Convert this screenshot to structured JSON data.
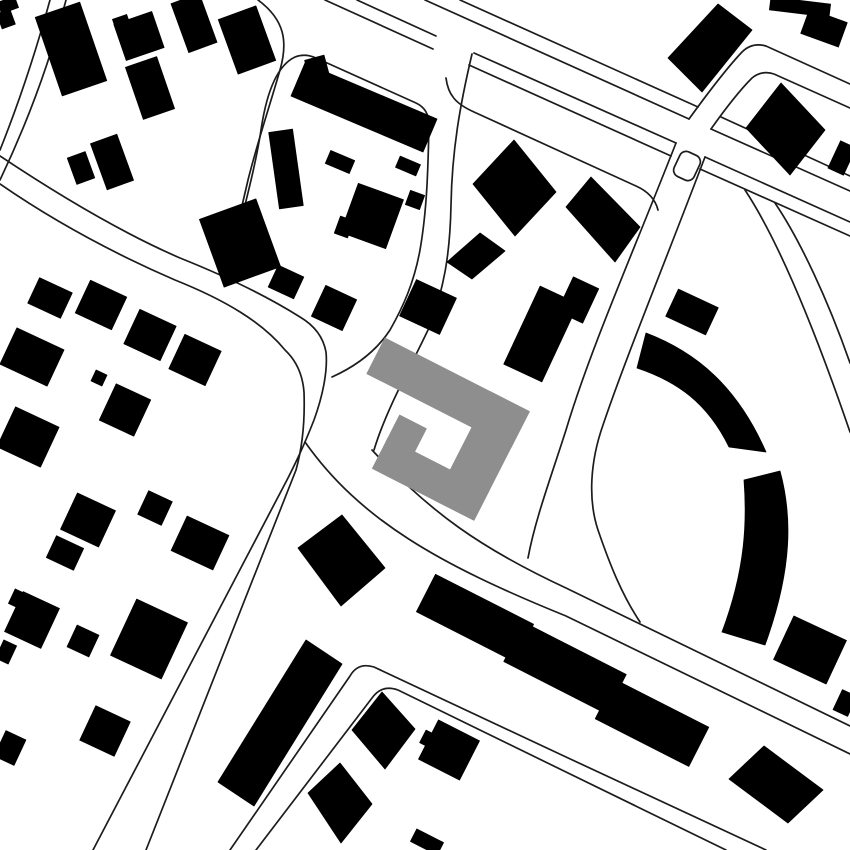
{
  "map": {
    "description": "black-and-white figure-ground site plan with gray highlighted building at center",
    "canvas": {
      "w": 850,
      "h": 850
    },
    "colors": {
      "background": "#ffffff",
      "building": "#000000",
      "highlight": "#8e8e8e",
      "road_line": "#1c1c1c"
    },
    "road_line_width": 1.7,
    "roads": [
      {
        "id": "r1-west",
        "d": "M50,0 Q28,80 0,150"
      },
      {
        "id": "r1-east",
        "d": "M66,0 Q42,92 0,180"
      },
      {
        "id": "strip-s1",
        "d": "M325,0 L433,49"
      },
      {
        "id": "strip-s2",
        "d": "M469,65 L671,156"
      },
      {
        "id": "strip-s3",
        "d": "M700,169 L850,236"
      },
      {
        "id": "main-s1",
        "d": "M357,0 L436,36"
      },
      {
        "id": "main-s2",
        "d": "M474,53 L676,143"
      },
      {
        "id": "main-s3",
        "d": "M705,157 L850,222"
      },
      {
        "id": "main-n1",
        "d": "M425,0 L689,119"
      },
      {
        "id": "main-n2",
        "d": "M711,129 L850,191"
      },
      {
        "id": "strip-n1",
        "d": "M460,0 L698,107"
      },
      {
        "id": "strip-n2",
        "d": "M721,117 L850,176"
      },
      {
        "id": "branch-ne-w",
        "d": "M689,119 C710,90 726,69 742,52 Q752,42 766,46 L850,84"
      },
      {
        "id": "branch-ne-e",
        "d": "M711,129 C728,105 740,90 752,78 Q762,70 774,74 L850,108"
      },
      {
        "id": "branch-s-w",
        "d": "M676,143 C630,260 590,350 566,430 C550,480 535,520 528,558"
      },
      {
        "id": "branch-s-e",
        "d": "M705,157 C660,275 625,360 603,425 C590,462 588,500 598,530 C610,565 622,595 640,622"
      },
      {
        "id": "se-road-n",
        "d": "M372,450 C430,512 480,548 566,588 L850,726"
      },
      {
        "id": "se-road-s",
        "d": "M305,442 C360,520 440,565 566,616 L850,754"
      },
      {
        "id": "corner-road-n",
        "d": "M230,850 L350,676 Q358,662 374,667 L566,757 L766,850"
      },
      {
        "id": "corner-road-s",
        "d": "M256,850 L372,698 Q382,684 398,690 L566,772 L726,850"
      },
      {
        "id": "west-road-n",
        "d": "M0,156 C60,196 120,232 180,258 C220,274 262,293 300,317 Q322,330 326,352 C328,372 322,398 314,420 C303,448 296,462 288,478 L93,850"
      },
      {
        "id": "west-road-s",
        "d": "M0,184 C55,222 115,254 175,280 C225,300 262,322 285,350 Q302,366 304,392 C305,420 303,445 296,470 L146,850"
      },
      {
        "id": "lane-w",
        "d": "M258,0 C285,20 288,42 280,70 C270,105 258,140 248,180 C240,215 232,248 224,272"
      },
      {
        "id": "block-outline",
        "d": "M230,266 C242,215 255,170 261,130 C266,96 276,66 295,57 Q305,53 316,58 L416,103 Q429,109 429,125 C428,170 427,210 420,250 C414,283 403,307 390,330 C375,353 352,368 332,377"
      },
      {
        "id": "n-road-e",
        "d": "M472,54 C460,105 452,150 451,205 C450,255 444,290 428,330 C410,368 386,410 374,450"
      },
      {
        "id": "right-block-n",
        "d": "M446,78 C448,95 456,104 474,112 L636,186 Q654,194 658,210"
      },
      {
        "id": "ring-outer",
        "d": "M775,203 C800,240 828,300 850,363"
      },
      {
        "id": "ring-inner",
        "d": "M745,190 C778,240 815,330 850,432"
      }
    ],
    "layby": {
      "cx": 687,
      "cy": 166,
      "w": 22,
      "h": 27,
      "rx": 7,
      "deg": 25
    },
    "building_rects": [
      [
        8,
        5,
        18,
        12,
        -20
      ],
      [
        6,
        19,
        14,
        16,
        -20
      ],
      [
        71,
        49,
        47,
        83,
        -19
      ],
      [
        122,
        24,
        15,
        15,
        -19
      ],
      [
        139,
        36,
        40,
        38,
        -19
      ],
      [
        150,
        88,
        33,
        55,
        -19
      ],
      [
        194,
        23,
        30,
        52,
        -20
      ],
      [
        247,
        40,
        40,
        58,
        -20
      ],
      [
        320,
        79,
        20,
        44,
        -15
      ],
      [
        286,
        169,
        24,
        77,
        -8
      ],
      [
        112,
        162,
        28,
        49,
        -20
      ],
      [
        81,
        168,
        19,
        28,
        -20
      ],
      [
        240,
        243,
        60,
        72,
        -20
      ],
      [
        286,
        282,
        28,
        24,
        25
      ],
      [
        334,
        308,
        34,
        34,
        25
      ],
      [
        428,
        307,
        44,
        40,
        25
      ],
      [
        50,
        298,
        36,
        28,
        25
      ],
      [
        101,
        305,
        40,
        36,
        25
      ],
      [
        32,
        357,
        52,
        40,
        25
      ],
      [
        150,
        335,
        40,
        38,
        25
      ],
      [
        195,
        360,
        40,
        38,
        25
      ],
      [
        99,
        378,
        12,
        12,
        25
      ],
      [
        125,
        410,
        38,
        40,
        25
      ],
      [
        28,
        437,
        48,
        44,
        25
      ],
      [
        88,
        520,
        42,
        40,
        25
      ],
      [
        65,
        553,
        30,
        24,
        25
      ],
      [
        155,
        508,
        26,
        26,
        25
      ],
      [
        200,
        543,
        46,
        38,
        25
      ],
      [
        372,
        216,
        48,
        52,
        20
      ],
      [
        344,
        227,
        14,
        18,
        20
      ],
      [
        415,
        200,
        15,
        15,
        20
      ],
      [
        340,
        162,
        26,
        14,
        23
      ],
      [
        408,
        166,
        22,
        12,
        23
      ],
      [
        541,
        334,
        42,
        86,
        25
      ],
      [
        578,
        300,
        28,
        38,
        25
      ],
      [
        692,
        312,
        44,
        30,
        25
      ],
      [
        800,
        7,
        60,
        13,
        7
      ],
      [
        824,
        28,
        40,
        26,
        20
      ],
      [
        842,
        158,
        17,
        30,
        25
      ],
      [
        810,
        650,
        58,
        48,
        25
      ],
      [
        845,
        703,
        16,
        22,
        25
      ],
      [
        32,
        620,
        40,
        44,
        25
      ],
      [
        20,
        600,
        18,
        16,
        25
      ],
      [
        6,
        652,
        14,
        20,
        25
      ],
      [
        83,
        641,
        24,
        24,
        25
      ],
      [
        149,
        639,
        56,
        62,
        25
      ],
      [
        105,
        731,
        38,
        38,
        25
      ],
      [
        10,
        748,
        22,
        28,
        25
      ],
      [
        475,
        618,
        110,
        42,
        27
      ],
      [
        565,
        668,
        115,
        44,
        27
      ],
      [
        652,
        723,
        105,
        44,
        27
      ],
      [
        449,
        750,
        46,
        44,
        27
      ],
      [
        430,
        740,
        16,
        14,
        27
      ],
      [
        427,
        842,
        30,
        14,
        27
      ]
    ],
    "building_polys": [
      [
        [
          305,
          63
        ],
        [
          437,
          119
        ],
        [
          423,
          152
        ],
        [
          291,
          96
        ]
      ],
      [
        [
          473,
          184
        ],
        [
          514,
          140
        ],
        [
          556,
          192
        ],
        [
          515,
          236
        ]
      ],
      [
        [
          447,
          262
        ],
        [
          480,
          233
        ],
        [
          505,
          251
        ],
        [
          472,
          279
        ]
      ],
      [
        [
          668,
          58
        ],
        [
          718,
          4
        ],
        [
          752,
          30
        ],
        [
          702,
          92
        ]
      ],
      [
        [
          746,
          128
        ],
        [
          781,
          83
        ],
        [
          825,
          130
        ],
        [
          790,
          175
        ]
      ],
      [
        [
          566,
          207
        ],
        [
          591,
          177
        ],
        [
          640,
          227
        ],
        [
          615,
          262
        ]
      ],
      [
        [
          298,
          548
        ],
        [
          342,
          515
        ],
        [
          385,
          568
        ],
        [
          341,
          606
        ]
      ],
      [
        [
          352,
          730
        ],
        [
          382,
          692
        ],
        [
          415,
          729
        ],
        [
          385,
          769
        ]
      ],
      [
        [
          308,
          793
        ],
        [
          340,
          763
        ],
        [
          372,
          804
        ],
        [
          341,
          843
        ]
      ],
      [
        [
          729,
          779
        ],
        [
          764,
          746
        ],
        [
          823,
          790
        ],
        [
          788,
          823
        ]
      ],
      [
        [
          306,
          640
        ],
        [
          342,
          664
        ],
        [
          254,
          806
        ],
        [
          218,
          782
        ]
      ]
    ],
    "arc_building_paths": [
      "M646,333 C696,352 737,386 766,452 L729,447 C707,402 676,381 637,368 Z",
      "M780,471 C792,515 793,568 765,645 L722,632 C746,568 747,520 744,480 Z"
    ],
    "highlight_building": {
      "origin": [
        385,
        338
      ],
      "angle": 27,
      "rects": [
        [
          0,
          0,
          162,
          40
        ],
        [
          118,
          0,
          44,
          122
        ],
        [
          48,
          88,
          114,
          34
        ],
        [
          48,
          62,
          30,
          30
        ]
      ]
    }
  }
}
